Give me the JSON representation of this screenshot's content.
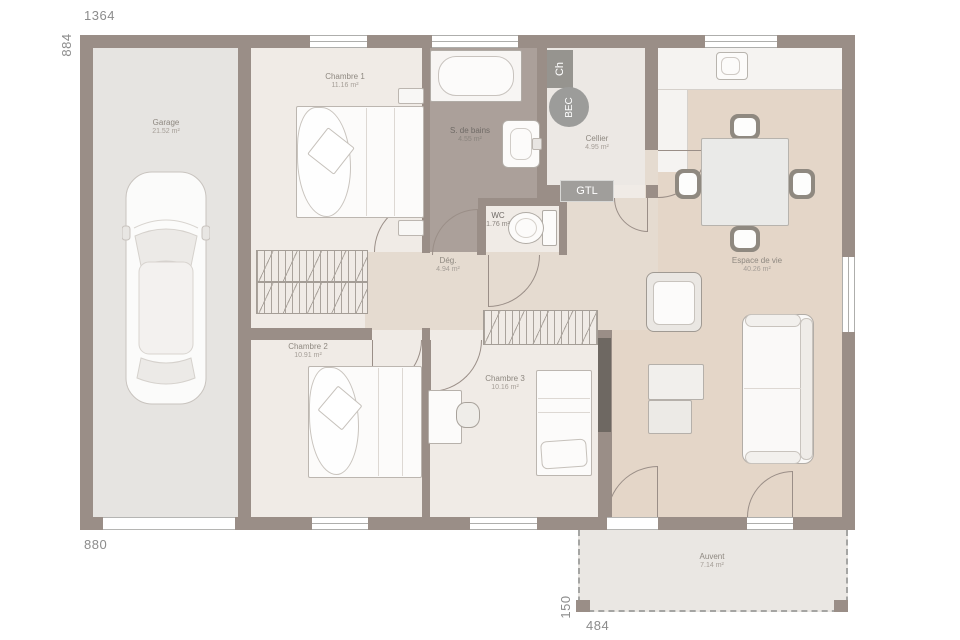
{
  "plan": {
    "dimensions": {
      "width_top": "1364",
      "height_left": "884",
      "width_bottom_left": "880",
      "auvent_height": "150",
      "auvent_width": "484"
    },
    "rooms": [
      {
        "name": "Garage",
        "area": "21.52 m²"
      },
      {
        "name": "Chambre 1",
        "area": "11.16 m²"
      },
      {
        "name": "S. de bains",
        "area": "4.55 m²"
      },
      {
        "name": "Cellier",
        "area": "4.95 m²"
      },
      {
        "name": "WC",
        "area": "1.76 m²"
      },
      {
        "name": "Dég.",
        "area": "4.94 m²"
      },
      {
        "name": "Espace de vie",
        "area": "40.26 m²"
      },
      {
        "name": "Chambre 2",
        "area": "10.91 m²"
      },
      {
        "name": "Chambre 3",
        "area": "10.16 m²"
      },
      {
        "name": "Auvent",
        "area": "7.14 m²"
      }
    ],
    "badges": {
      "boiler": "Ch",
      "bec": "BEC",
      "gtl": "GTL"
    },
    "colors": {
      "wall": "#9a8e87",
      "bedroom_floor": "#f0ebe6",
      "garage_floor": "#e6e4e1",
      "bath_floor": "#aba09a",
      "hall_floor": "#e5dbd0",
      "living_floor": "#e4d6c8",
      "cellier_floor": "#ece8e4",
      "auvent_floor": "#eae7e3"
    }
  }
}
